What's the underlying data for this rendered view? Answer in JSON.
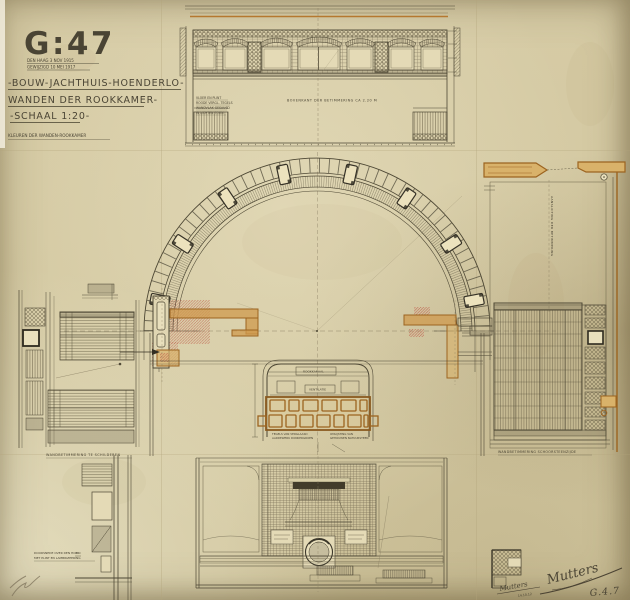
{
  "sheet": {
    "code": "G:47",
    "stamp_lines": [
      "DEN HAAG 3 NOV 1915",
      "GEWIJZIGD 10 MEI 1917"
    ],
    "titles": [
      "-BOUW-JACHTHUIS-HOENDERLO-",
      "WANDEN DER ROOKKAMER-",
      "-SCHAAL 1:20-"
    ],
    "subtitle": "KLEUREN DER WANDEN-ROOKKAMER",
    "code_pencil": "G.4.7"
  },
  "notes": {
    "top_left_block": [
      "VLOER EN PLINT",
      "ROODE VERGL. TEGELS",
      "WANDVLAK GESAUSD",
      "IN LICHTEN TOON"
    ],
    "top_center_line": "BOVENKANT DER BETIMMERING CA 2.20 M",
    "right_vertical": "AANSLUITING DER BETIMMERING",
    "left_panel_label": "WANDBETIMMERING TE SCHILDEREN",
    "right_panel_label": "WANDBETIMMERING SCHOORSTEENZIJDE",
    "fireplace_top": "ROOKKANAAL",
    "fireplace_mid": "VENTILATIE",
    "fireplace_note_left": [
      "TEGELS VAN VERGLAASD",
      "AARDEWERK DONKERGROEN"
    ],
    "fireplace_note_right": [
      "OMLIJSTING VAN",
      "GEHOUWEN NATUURSTEEN"
    ],
    "bottom_left_note": [
      "DOORSNEDE OVER DEN HOEK",
      "MET PLINT EN LAMBRIZEERING"
    ]
  },
  "signatures": {
    "small": "Mutters",
    "small_date": "14.10.12",
    "large": "Mutters"
  },
  "palette": {
    "paper": "#d5caa4",
    "ink": "#4a4434",
    "wall_accent_orange": "#b5782f",
    "section_red": "#c05a48",
    "pencil": "#6f654c"
  }
}
